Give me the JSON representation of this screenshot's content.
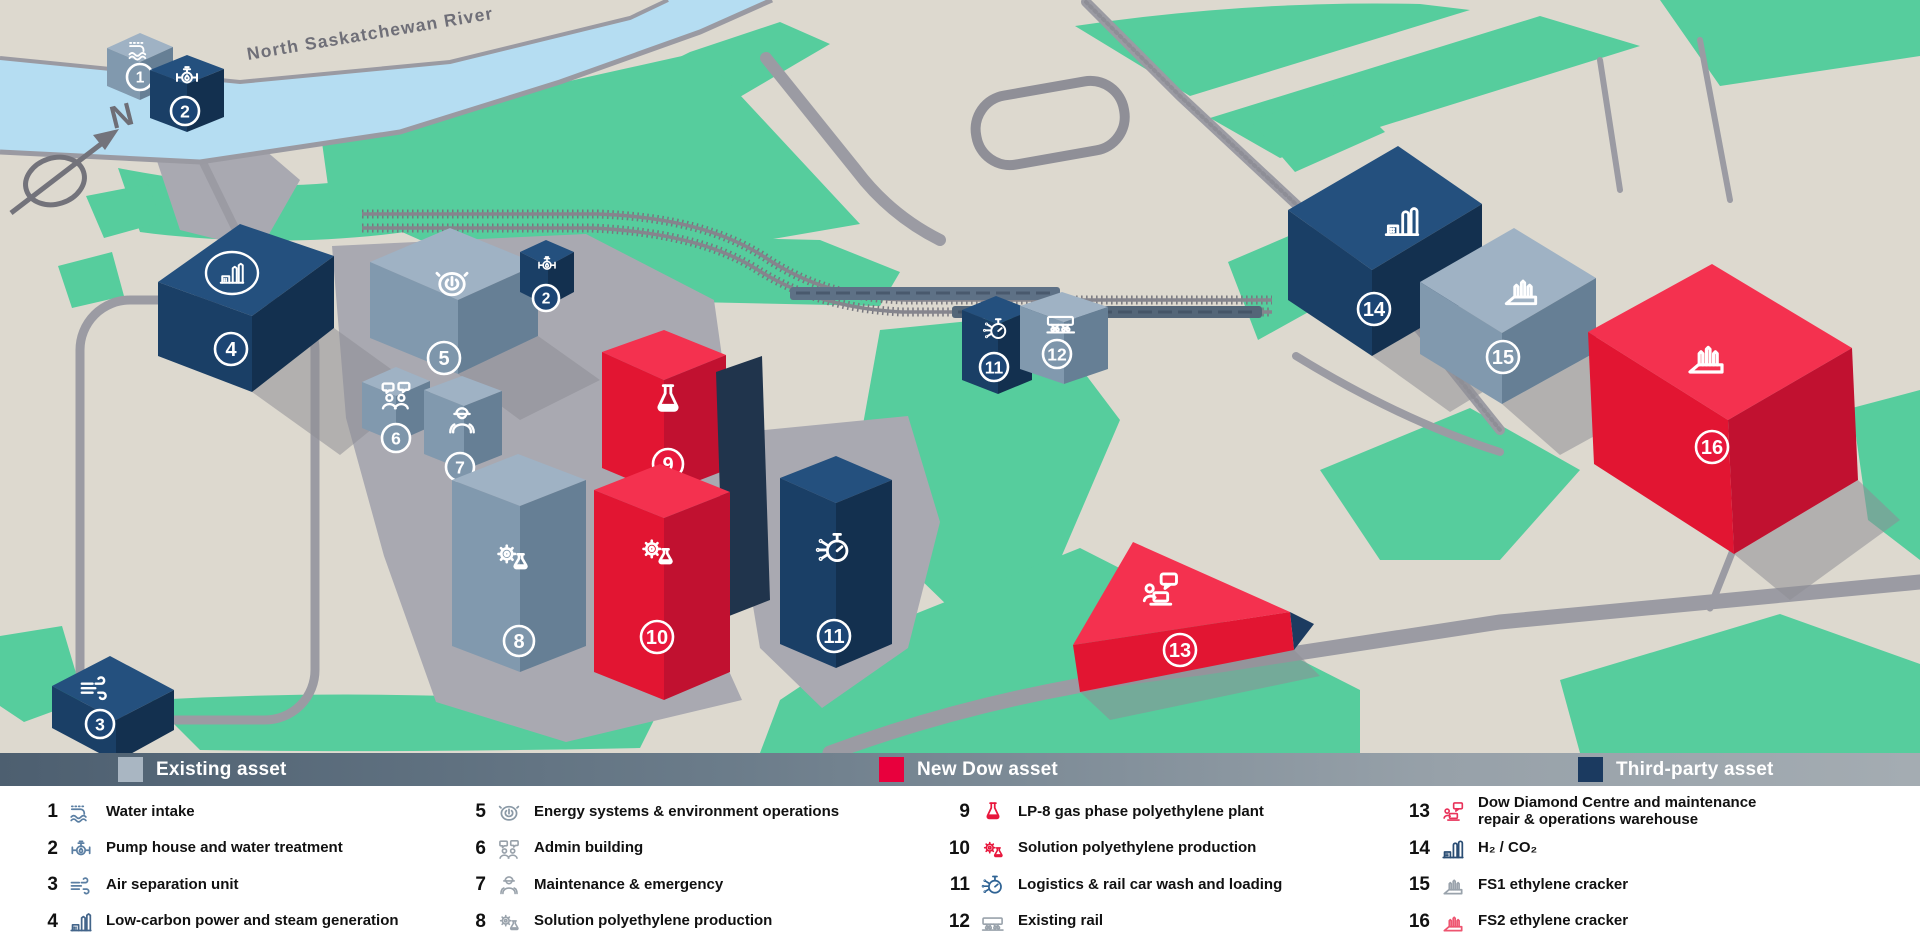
{
  "map": {
    "river_label": "North Saskatchewan River",
    "compass_letter": "N"
  },
  "legend_bar": {
    "items": [
      {
        "label": "Existing asset",
        "color": "#a9b6c2"
      },
      {
        "label": "New Dow asset",
        "color": "#e8003d"
      },
      {
        "label": "Third-party asset",
        "color": "#1b3a60"
      }
    ]
  },
  "legend_list": {
    "items": [
      {
        "number": "1",
        "label": "Water intake",
        "icon": "water-intake-icon",
        "icon_color": "#5b7fa3"
      },
      {
        "number": "2",
        "label": "Pump house and water treatment",
        "icon": "pump-icon",
        "icon_color": "#5b7fa3"
      },
      {
        "number": "3",
        "label": "Air separation unit",
        "icon": "air-separation-icon",
        "icon_color": "#5b7fa3"
      },
      {
        "number": "4",
        "label": "Low-carbon power and steam generation",
        "icon": "power-plant-icon",
        "icon_color": "#43658a"
      },
      {
        "number": "5",
        "label": "Energy systems & environment operations",
        "icon": "energy-gauge-icon",
        "icon_color": "#8a99a6"
      },
      {
        "number": "6",
        "label": "Admin building",
        "icon": "admin-people-icon",
        "icon_color": "#99a2ab"
      },
      {
        "number": "7",
        "label": "Maintenance & emergency",
        "icon": "maintenance-worker-icon",
        "icon_color": "#99a2ab"
      },
      {
        "number": "8",
        "label": "Solution polyethylene production",
        "icon": "gear-flask-icon",
        "icon_color": "#9aa3ac"
      },
      {
        "number": "9",
        "label": "LP-8 gas phase polyethylene plant",
        "icon": "flask-icon",
        "icon_color": "#e8173c"
      },
      {
        "number": "10",
        "label": "Solution polyethylene production",
        "icon": "gear-flask-icon",
        "icon_color": "#e8173c"
      },
      {
        "number": "11",
        "label": "Logistics & rail car wash and loading",
        "icon": "stopwatch-wash-icon",
        "icon_color": "#2f6394"
      },
      {
        "number": "12",
        "label": "Existing rail",
        "icon": "rail-car-icon",
        "icon_color": "#9aa3ac"
      },
      {
        "number": "13",
        "label": "Dow Diamond Centre and maintenance repair & operations warehouse",
        "icon": "service-centre-icon",
        "icon_color": "#e8325a"
      },
      {
        "number": "14",
        "label": "H₂ / CO₂",
        "icon": "h2-co2-plant-icon",
        "icon_color": "#2a4d74"
      },
      {
        "number": "15",
        "label": "FS1 ethylene cracker",
        "icon": "cracker-icon",
        "icon_color": "#9aa3ac"
      },
      {
        "number": "16",
        "label": "FS2 ethylene cracker",
        "icon": "cracker-icon",
        "icon_color": "#ee5570"
      }
    ]
  }
}
